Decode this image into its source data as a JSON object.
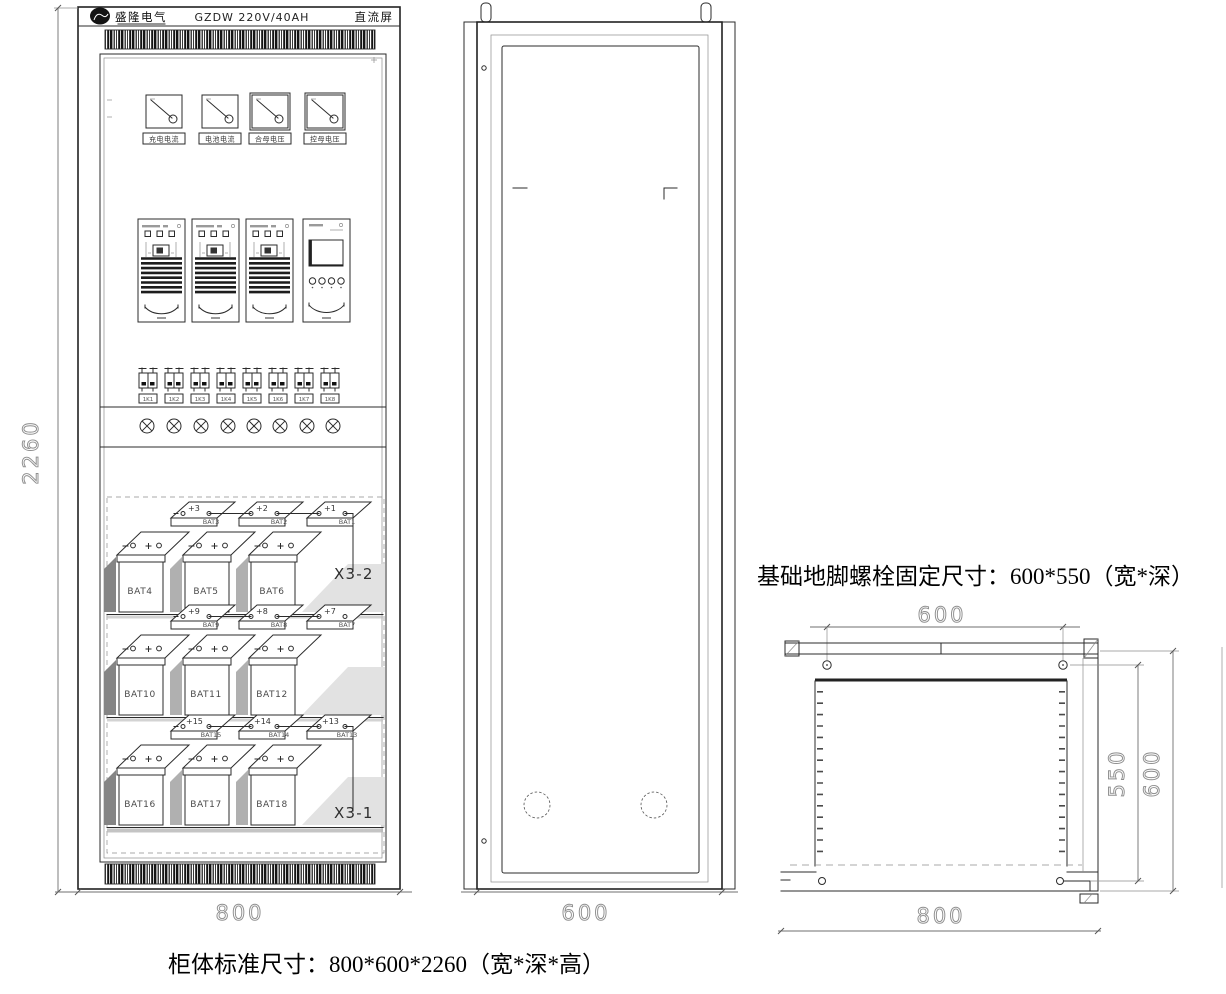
{
  "title_block": {
    "company": "盛隆电气",
    "model": "GZDW 220V/40AH",
    "product": "直流屏"
  },
  "front_view": {
    "meters": [
      "充电电流",
      "电池电流",
      "合母电压",
      "控母电压"
    ],
    "breakers": [
      "1K1",
      "1K2",
      "1K3",
      "1K4",
      "1K5",
      "1K6",
      "1K7",
      "1K8"
    ],
    "battery_rows": [
      {
        "flat": [
          "BAT3",
          "BAT2",
          "BAT1"
        ],
        "terminals": [
          "+3",
          "+2",
          "+1"
        ],
        "tall": [
          "BAT4",
          "BAT5",
          "BAT6"
        ],
        "connector": "X3-2"
      },
      {
        "flat": [
          "BAT9",
          "BAT8",
          "BAT7"
        ],
        "terminals": [
          "+9",
          "+8",
          "+7"
        ],
        "tall": [
          "BAT10",
          "BAT11",
          "BAT12"
        ],
        "connector": ""
      },
      {
        "flat": [
          "BAT15",
          "BAT14",
          "BAT13"
        ],
        "terminals": [
          "+15",
          "+14",
          "+13"
        ],
        "tall": [
          "BAT16",
          "BAT17",
          "BAT18"
        ],
        "connector": "X3-1"
      }
    ],
    "dim_width": "800",
    "dim_height": "2260"
  },
  "side_view": {
    "dim_depth": "600"
  },
  "top_view": {
    "note": "基础地脚螺栓固定尺寸：600*550（宽*深）",
    "dim_bolt_width": "600",
    "dim_width": "800",
    "dim_bolt_depth": "550",
    "dim_depth": "600"
  },
  "footer": {
    "note": "柜体标准尺寸：800*600*2260（宽*深*高）"
  }
}
